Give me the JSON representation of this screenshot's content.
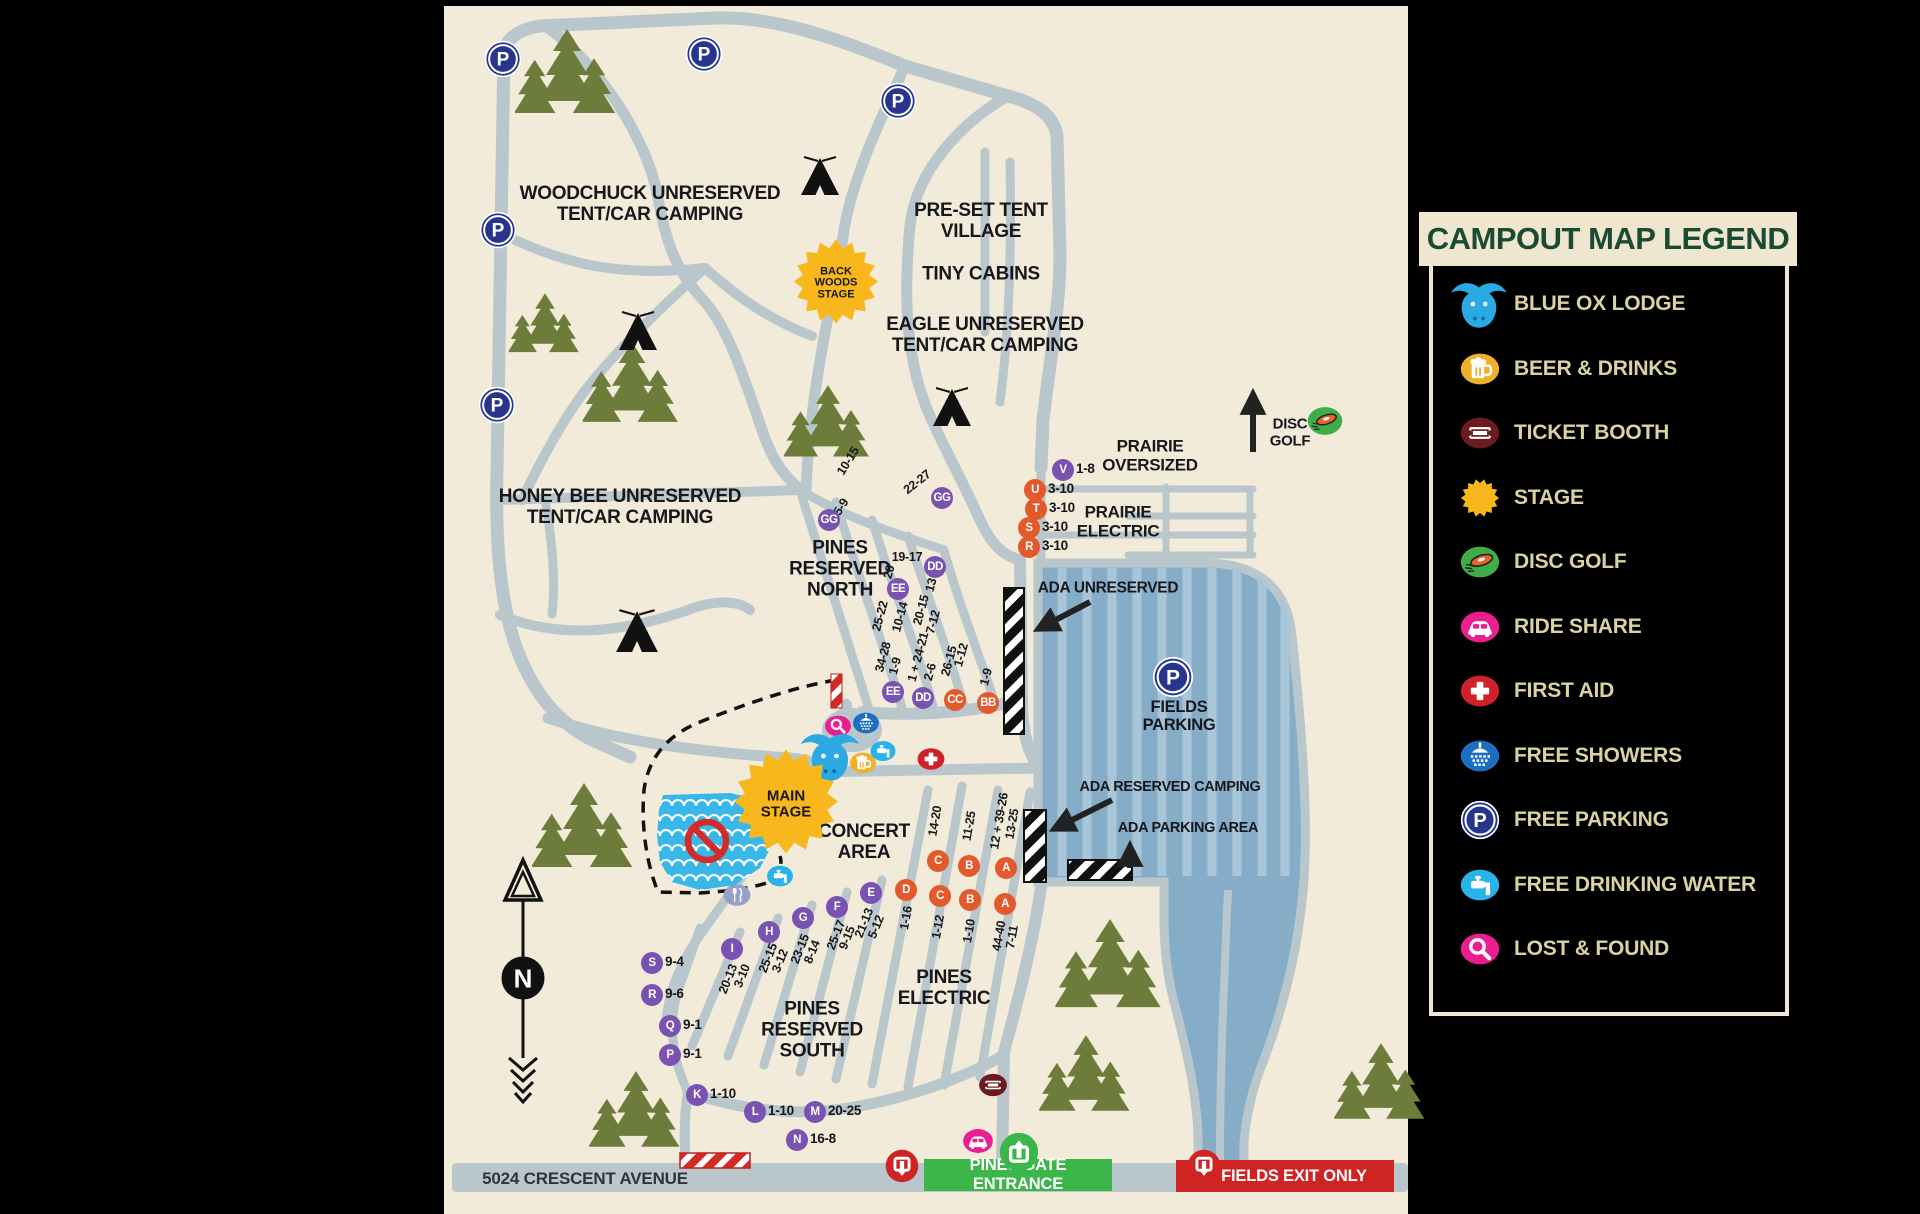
{
  "legend": {
    "title": "CAMPOUT MAP LEGEND",
    "items": [
      {
        "icon": "blue-ox-icon",
        "label": "BLUE OX LODGE"
      },
      {
        "icon": "beer-icon",
        "label": "BEER & DRINKS"
      },
      {
        "icon": "ticket-icon",
        "label": "TICKET BOOTH"
      },
      {
        "icon": "stage-icon",
        "label": "STAGE"
      },
      {
        "icon": "disc-golf-icon",
        "label": "DISC GOLF"
      },
      {
        "icon": "ride-share-icon",
        "label": "RIDE SHARE"
      },
      {
        "icon": "first-aid-icon",
        "label": "FIRST AID"
      },
      {
        "icon": "shower-icon",
        "label": "FREE SHOWERS"
      },
      {
        "icon": "parking-icon",
        "label": "FREE PARKING"
      },
      {
        "icon": "water-icon",
        "label": "FREE DRINKING WATER"
      },
      {
        "icon": "lost-found-icon",
        "label": "LOST & FOUND"
      }
    ]
  },
  "map": {
    "street_label": {
      "text": "5024 CRESCENT AVENUE",
      "x": 585,
      "y": 1179
    },
    "compass_letter": "N",
    "banners": {
      "entrance": {
        "text": "PINES GATE ENTRANCE",
        "x": 1018,
        "y": 1175,
        "w": 188,
        "h": 32
      },
      "exit": {
        "text": "FIELDS EXIT ONLY",
        "x": 1285,
        "y": 1176,
        "w": 200,
        "h": 32
      }
    },
    "stages": [
      {
        "name": "back-woods-stage",
        "text": "BACK\nWOODS\nSTAGE",
        "x": 836,
        "y": 284,
        "r1": 42,
        "r2": 34,
        "fs": 11
      },
      {
        "name": "main-stage",
        "text": "MAIN\nSTAGE",
        "x": 786,
        "y": 804,
        "r1": 52,
        "r2": 42,
        "fs": 15
      }
    ],
    "area_labels": [
      [
        "woodchuck-label",
        "WOODCHUCK UNRESERVED\nTENT/CAR CAMPING",
        650,
        205,
        19
      ],
      [
        "preset-tent-village-label",
        "PRE-SET TENT\nVILLAGE",
        981,
        222,
        19
      ],
      [
        "tiny-cabins-label",
        "TINY CABINS",
        981,
        275,
        19
      ],
      [
        "eagle-label",
        "EAGLE UNRESERVED\nTENT/CAR CAMPING",
        985,
        336,
        19
      ],
      [
        "honey-bee-label",
        "HONEY BEE UNRESERVED\nTENT/CAR CAMPING",
        620,
        508,
        19
      ],
      [
        "pines-reserved-north-label",
        "PINES\nRESERVED\nNORTH",
        840,
        570,
        19
      ],
      [
        "prairie-oversized-label",
        "PRAIRIE\nOVERSIZED",
        1150,
        456,
        17
      ],
      [
        "prairie-electric-label",
        "PRAIRIE\nELECTRIC",
        1118,
        522,
        17
      ],
      [
        "ada-unreserved-label",
        "ADA UNRESERVED",
        1108,
        588,
        15.5
      ],
      [
        "fields-parking-label",
        "FIELDS\nPARKING",
        1179,
        716,
        16.5
      ],
      [
        "ada-reserved-camping-label",
        "ADA RESERVED CAMPING",
        1170,
        788,
        14.5
      ],
      [
        "ada-parking-area-label",
        "ADA PARKING AREA",
        1188,
        829,
        14.5
      ],
      [
        "concert-area-label",
        "CONCERT\nAREA",
        864,
        843,
        19
      ],
      [
        "pines-electric-label",
        "PINES\nELECTRIC",
        944,
        989,
        19
      ],
      [
        "pines-reserved-south-label",
        "PINES\nRESERVED\nSOUTH",
        812,
        1031,
        19
      ],
      [
        "disc-golf-label",
        "DISC\nGOLF",
        1290,
        433,
        15
      ]
    ],
    "site_markers": [
      [
        "GG",
        "",
        "p",
        829,
        520
      ],
      [
        "GG",
        "",
        "p",
        942,
        498
      ],
      [
        "DD",
        "",
        "p",
        935,
        567
      ],
      [
        "EE",
        "",
        "p",
        898,
        589
      ],
      [
        "EE",
        "",
        "p",
        893,
        692
      ],
      [
        "DD",
        "",
        "p",
        923,
        698
      ],
      [
        "CC",
        "",
        "o",
        955,
        700
      ],
      [
        "BB",
        "",
        "o",
        988,
        703
      ],
      [
        "V",
        "1-8",
        "p",
        1063,
        470
      ],
      [
        "U",
        "3-10",
        "o",
        1035,
        490
      ],
      [
        "T",
        "3-10",
        "o",
        1036,
        509
      ],
      [
        "S",
        "3-10",
        "o",
        1029,
        528
      ],
      [
        "R",
        "3-10",
        "o",
        1029,
        547
      ],
      [
        "C",
        "",
        "o",
        938,
        861
      ],
      [
        "B",
        "",
        "o",
        969,
        866
      ],
      [
        "A",
        "",
        "o",
        1006,
        868
      ],
      [
        "D",
        "",
        "o",
        906,
        890
      ],
      [
        "C",
        "",
        "o",
        940,
        896
      ],
      [
        "B",
        "",
        "o",
        970,
        900
      ],
      [
        "A",
        "",
        "o",
        1005,
        904
      ],
      [
        "E",
        "",
        "p",
        871,
        893
      ],
      [
        "F",
        "",
        "p",
        837,
        907
      ],
      [
        "G",
        "",
        "p",
        803,
        918
      ],
      [
        "H",
        "",
        "p",
        769,
        932
      ],
      [
        "I",
        "",
        "p",
        732,
        949
      ],
      [
        "S",
        "9-4",
        "p",
        652,
        963
      ],
      [
        "R",
        "9-6",
        "p",
        652,
        995
      ],
      [
        "Q",
        "9-1",
        "p",
        670,
        1026
      ],
      [
        "P",
        "9-1",
        "p",
        670,
        1055
      ],
      [
        "K",
        "1-10",
        "p",
        697,
        1095
      ],
      [
        "L",
        "1-10",
        "p",
        755,
        1112
      ],
      [
        "M",
        "20-25",
        "p",
        815,
        1112
      ],
      [
        "N",
        "16-8",
        "p",
        797,
        1140
      ]
    ],
    "rotated_labels": [
      [
        "10-15",
        848,
        461,
        -58
      ],
      [
        "5-9",
        841,
        507,
        -58
      ],
      [
        "22-27",
        917,
        482,
        -38
      ],
      [
        "19-17",
        907,
        557,
        0
      ],
      [
        "20",
        889,
        572,
        -75
      ],
      [
        "13",
        931,
        585,
        -75
      ],
      [
        "25-22",
        880,
        616,
        -75
      ],
      [
        "10-14",
        900,
        617,
        -75
      ],
      [
        "20-15",
        921,
        610,
        -75
      ],
      [
        "7-12",
        933,
        622,
        -75
      ],
      [
        "34-28",
        883,
        657,
        -75
      ],
      [
        "1-9",
        895,
        666,
        -75
      ],
      [
        "1 + 24-21",
        918,
        657,
        -75
      ],
      [
        "2-6",
        930,
        672,
        -75
      ],
      [
        "26-15",
        949,
        661,
        -75
      ],
      [
        "1-12",
        961,
        655,
        -75
      ],
      [
        "1-9",
        986,
        677,
        -75
      ],
      [
        "14-20",
        935,
        821,
        -80
      ],
      [
        "11-25",
        969,
        826,
        -80
      ],
      [
        "12 + 39-26",
        999,
        821,
        -80
      ],
      [
        "13-25",
        1012,
        824,
        -80
      ],
      [
        "1-16",
        906,
        918,
        -80
      ],
      [
        "1-12",
        938,
        927,
        -80
      ],
      [
        "1-10",
        969,
        931,
        -80
      ],
      [
        "44-40",
        999,
        936,
        -80
      ],
      [
        "7-11",
        1012,
        937,
        -80
      ],
      [
        "20-13",
        728,
        979,
        -68
      ],
      [
        "3-10",
        742,
        976,
        -68
      ],
      [
        "25-15",
        768,
        958,
        -68
      ],
      [
        "3-12",
        780,
        961,
        -68
      ],
      [
        "23-15",
        800,
        949,
        -68
      ],
      [
        "8-14",
        812,
        952,
        -68
      ],
      [
        "25-17",
        836,
        935,
        -68
      ],
      [
        "9-15",
        847,
        938,
        -68
      ],
      [
        "21-13",
        864,
        923,
        -68
      ],
      [
        "5-12",
        876,
        927,
        -68
      ]
    ],
    "parking_markers": [
      [
        503,
        59
      ],
      [
        704,
        54
      ],
      [
        898,
        101
      ],
      [
        498,
        230
      ],
      [
        497,
        405
      ],
      [
        1173,
        677
      ]
    ],
    "pois": [
      [
        "lost-found-icon",
        838,
        726,
        27
      ],
      [
        "shower-icon",
        866,
        723,
        27
      ],
      [
        "blue-ox-icon",
        831,
        756,
        52
      ],
      [
        "beer-icon",
        863,
        763,
        27
      ],
      [
        "water-icon",
        883,
        751,
        26
      ],
      [
        "first-aid-icon",
        931,
        759,
        28
      ],
      [
        "food-icon",
        737,
        895,
        28
      ],
      [
        "water-icon",
        780,
        876,
        27
      ],
      [
        "ride-share-icon",
        978,
        1141,
        31
      ],
      [
        "ticket-icon",
        993,
        1085,
        29
      ],
      [
        "exit-icon",
        902,
        1166,
        34
      ],
      [
        "entrance-icon",
        1019,
        1152,
        40
      ],
      [
        "exit-icon",
        1204,
        1166,
        34
      ],
      [
        "disc-golf-icon",
        1325,
        421,
        36
      ]
    ],
    "nature": {
      "trees": [
        [
          567,
          70,
          1
        ],
        [
          545,
          322,
          0.7
        ],
        [
          632,
          381,
          0.95
        ],
        [
          828,
          420,
          0.85
        ],
        [
          584,
          824,
          1
        ],
        [
          636,
          1108,
          0.9
        ],
        [
          1110,
          962,
          1.05
        ],
        [
          1086,
          1072,
          0.9
        ],
        [
          1381,
          1080,
          0.9
        ]
      ],
      "tents": [
        [
          820,
          175,
          1
        ],
        [
          638,
          330,
          1
        ],
        [
          637,
          630,
          1.1
        ],
        [
          952,
          406,
          1
        ]
      ]
    },
    "colors": {
      "cream": "#f2ebd9",
      "road": "#b9c7cc",
      "pond": "#3ab7e9",
      "parking_lot": "#85adc8",
      "parking_stripe": "#a9c6d9",
      "tree": "#6d7c3b",
      "purple": "#7a52b2",
      "orange": "#e2592c",
      "navy": "#27368c",
      "pink": "#ea1e90",
      "red": "#cf2127",
      "shower_blue": "#1c6fc0",
      "water_blue": "#29b4e9",
      "beer_amber": "#efb02a",
      "ticket_maroon": "#6b1a1d",
      "entrance_green": "#3cb54a",
      "exit_red": "#cf2424",
      "stage_yellow": "#f7b71d",
      "legend_text": "#d9d2a2",
      "legend_green": "#1b4a33",
      "ox_blue": "#2aa9e2",
      "food_periwinkle": "#96a0cd"
    }
  }
}
